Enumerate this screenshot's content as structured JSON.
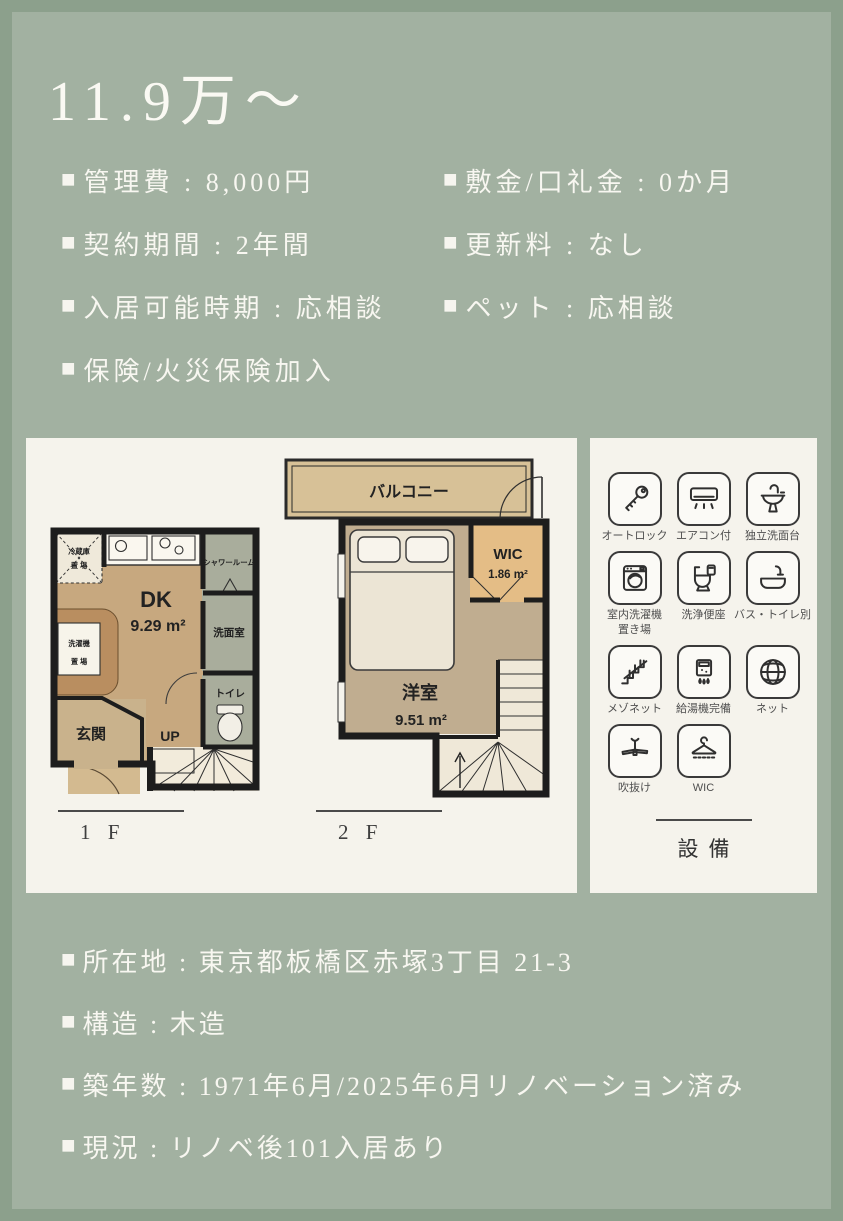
{
  "colors": {
    "frame": "#8ca08c",
    "background": "#a2b1a1",
    "panel": "#f5f3ec",
    "text": "#f8f7f1",
    "plan_tan": "#c7a87f",
    "plan_gray": "#a9ad9c",
    "wic_tan": "#e4bd86"
  },
  "glyphs": {
    "bullet": "■"
  },
  "title": "11.9万～",
  "summary": {
    "rows": [
      {
        "l": "管理費 : 8,000円",
        "r": "敷金/口礼金 : 0か月"
      },
      {
        "l": "契約期間 : 2年間",
        "r": "更新料 : なし"
      },
      {
        "l": "入居可能時期 : 応相談",
        "r": "ペット : 応相談"
      },
      {
        "l": "保険/火災保険加入"
      }
    ]
  },
  "floorplan": {
    "f1": {
      "name": "1 F",
      "dk": "DK",
      "dk_area": "9.29 m²",
      "shower": "シャワールーム",
      "washroom": "洗面室",
      "toilet": "トイレ",
      "entrance": "玄関",
      "up": "UP",
      "fridge_l1": "冷蔵庫",
      "fridge_l2": "置 場",
      "laundry_l1": "洗濯機",
      "laundry_l2": "置 場"
    },
    "f2": {
      "name": "2 F",
      "balcony": "バルコニー",
      "room": "洋室",
      "room_area": "9.51 m²",
      "wic": "WIC",
      "wic_area": "1.86 m²"
    }
  },
  "equipment": {
    "heading": "設備",
    "items": [
      {
        "icon": "key-icon",
        "label": "オートロック"
      },
      {
        "icon": "air-conditioner-icon",
        "label": "エアコン付"
      },
      {
        "icon": "washbasin-icon",
        "label": "独立洗面台"
      },
      {
        "icon": "washing-machine-icon",
        "label": "室内洗濯機\n置き場"
      },
      {
        "icon": "bidet-toilet-icon",
        "label": "洗浄便座"
      },
      {
        "icon": "bathtub-icon",
        "label": "バス・トイレ別"
      },
      {
        "icon": "stairs-icon",
        "label": "メゾネット"
      },
      {
        "icon": "water-heater-icon",
        "label": "給湯機完備"
      },
      {
        "icon": "globe-icon",
        "label": "ネット"
      },
      {
        "icon": "ceiling-fan-icon",
        "label": "吹抜け"
      },
      {
        "icon": "hanger-icon",
        "label": "WIC"
      }
    ]
  },
  "details": {
    "rows": [
      "所在地 : 東京都板橋区赤塚3丁目 21-3",
      "構造 : 木造",
      "築年数 : 1971年6月/2025年6月リノベーション済み",
      "現況 : リノベ後101入居あり"
    ]
  }
}
